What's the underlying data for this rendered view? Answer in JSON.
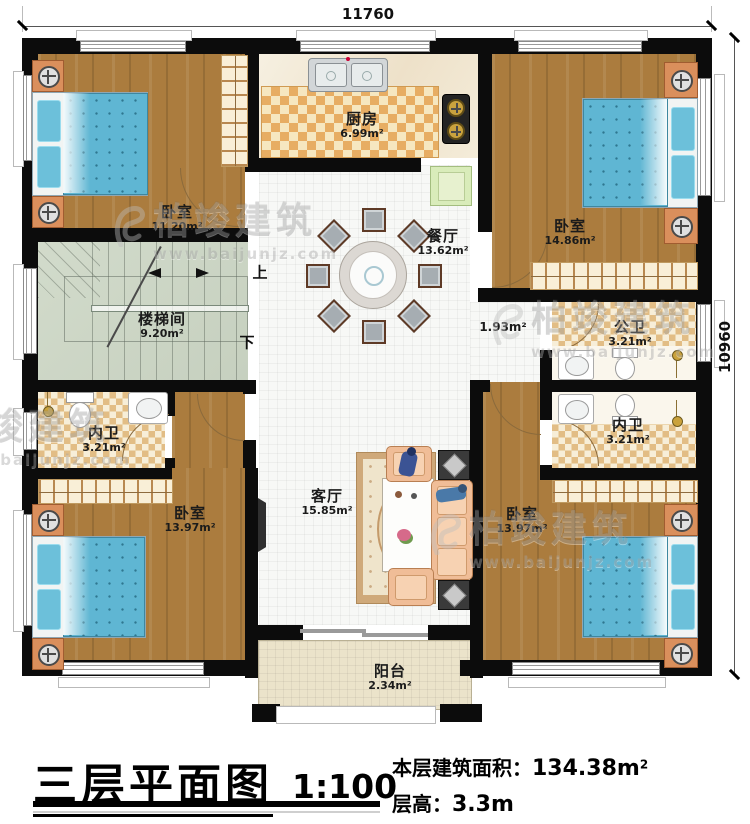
{
  "dimensions": {
    "top": "11760",
    "right": "10960"
  },
  "rooms": {
    "bedroom_tl": {
      "name": "卧室",
      "area": "11.20m²"
    },
    "kitchen": {
      "name": "厨房",
      "area": "6.99m²"
    },
    "bedroom_tr": {
      "name": "卧室",
      "area": "14.86m²"
    },
    "dining": {
      "name": "餐厅",
      "area": "13.62m²"
    },
    "stairwell": {
      "name": "楼梯间",
      "area": "9.20m²"
    },
    "bath_public": {
      "name": "公卫",
      "area": "3.21m²"
    },
    "bath_left": {
      "name": "内卫",
      "area": "3.21m²"
    },
    "bath_right": {
      "name": "内卫",
      "area": "3.21m²"
    },
    "bedroom_bl": {
      "name": "卧室",
      "area": "13.97m²"
    },
    "living": {
      "name": "客厅",
      "area": "15.85m²"
    },
    "bedroom_br": {
      "name": "卧室",
      "area": "13.97m²"
    },
    "balcony": {
      "name": "阳台",
      "area": "2.34m²"
    }
  },
  "corridor_area": "1.93m²",
  "stairs": {
    "up": "上",
    "down": "下"
  },
  "watermark": {
    "brand": "柏竣建筑",
    "url": "www.baijunjz.com"
  },
  "title_block": {
    "title": "三层平面图",
    "scale": "1:100",
    "area_label": "本层建筑面积：",
    "area_value": "134.38m",
    "area_sup": "2",
    "height_label": "层高：",
    "height_value": "3.3m"
  },
  "colors": {
    "wall": "#0c0c0c",
    "wood": "#ab7c3e",
    "bed": "#5fb6d3",
    "stair": "#ccd6c4",
    "checker": "#e7ad63"
  }
}
